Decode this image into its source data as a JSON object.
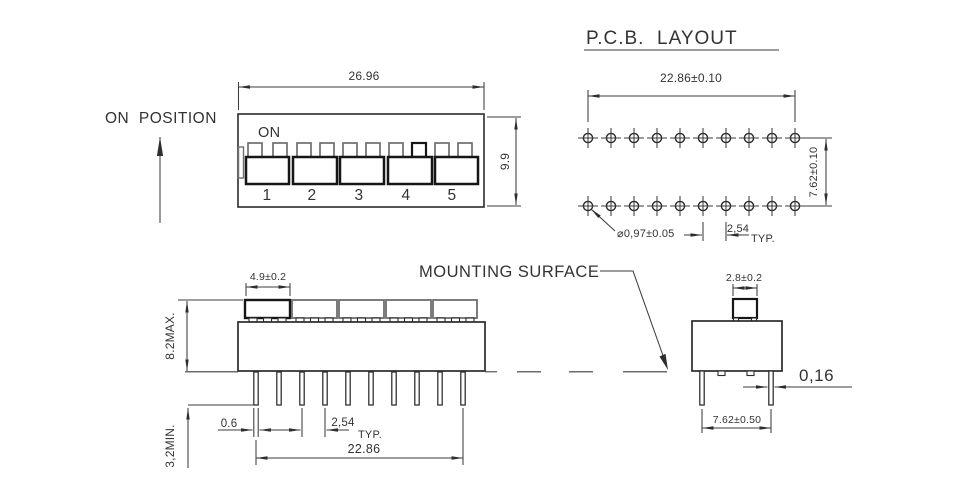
{
  "colors": {
    "background": "#ffffff",
    "outline": "#2b2b2b",
    "dimension_line": "#3c3c3c",
    "muted_gray": "#6e6e6e",
    "text": "#333333"
  },
  "top_view": {
    "on_position_label": "ON  POSITION",
    "overall_width": "26.96",
    "overall_depth": "9.9",
    "on_label": "ON",
    "switch_numbers": [
      "1",
      "2",
      "3",
      "4",
      "5"
    ]
  },
  "pcb_layout": {
    "title": "P.C.B.  LAYOUT",
    "hole_span": "22.86±0.10",
    "row_spacing": "7.62±0.10",
    "hole_diameter": "⌀0,97±0.05",
    "hole_pitch": "2,54",
    "pitch_qualifier": "TYP."
  },
  "side_view": {
    "mounting_surface_label": "MOUNTING SURFACE",
    "actuator_width": "4.9±0.2",
    "seated_height": "8.2MAX.",
    "pin_length": "3,2MIN.",
    "pin_width": "0.6",
    "pin_pitch": "2,54",
    "pitch_qualifier": "TYP.",
    "pin_span": "22.86"
  },
  "end_view": {
    "actuator_width": "2.8±0.2",
    "pin_thickness": "0,16",
    "pin_row_spacing": "7.62±0.50"
  }
}
